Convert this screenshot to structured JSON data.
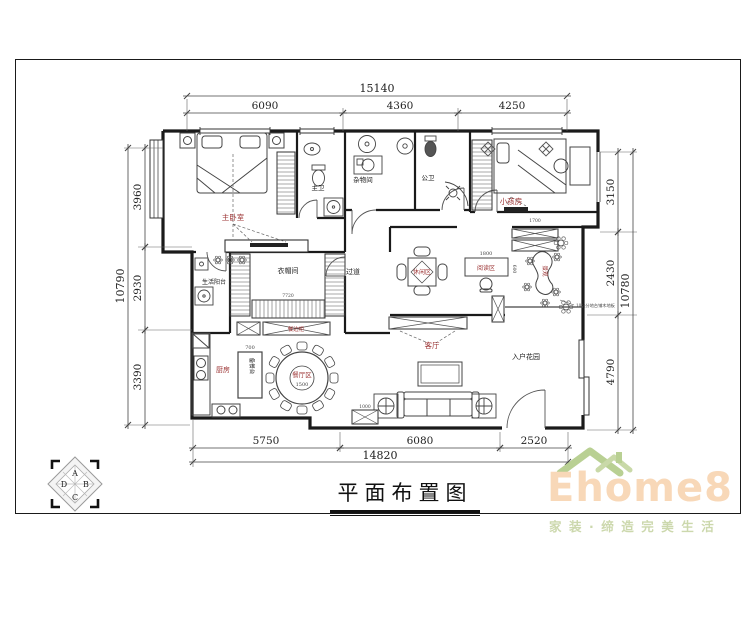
{
  "sheet": {
    "title": "平面布置图"
  },
  "dimensions": {
    "top": {
      "overall": "15140",
      "segments": [
        "6090",
        "4360",
        "4250"
      ]
    },
    "bottom": {
      "overall": "14820",
      "segments": [
        "5750",
        "6080",
        "2520"
      ]
    },
    "left": {
      "overall": "10790",
      "segments": [
        "3960",
        "2930",
        "3390"
      ]
    },
    "right": {
      "overall": "10780",
      "segments": [
        "3150",
        "2430",
        "4790"
      ]
    }
  },
  "rooms": {
    "master_bedroom": "主卧室",
    "master_bath": "主卫",
    "storage": "杂物间",
    "public_bath": "公卫",
    "kids_room": "小孩房",
    "cloakroom": "衣帽间",
    "hallway": "过道",
    "living_balcony": "生活阳台",
    "kitchen": "厨房",
    "dining_zone": "餐厅区",
    "living_room": "客厅",
    "reading_zone": "阅读区",
    "leisure_zone": "休闲区",
    "entry_garden": "入户花园",
    "sideboard": "餐边柜",
    "prep_counter": "备餐台",
    "landscape": "景观"
  },
  "inline_dims": {
    "dining_table": "1500",
    "island": "700",
    "desk_width": "1800",
    "desk_depth": "600",
    "side_cabinet": "1000",
    "cloak_width": "7720",
    "top_cabinet": "1700"
  },
  "annotations": {
    "platform_note": "10公分地台铺木地板"
  },
  "compass": {
    "top": "A",
    "right": "B",
    "bottom": "C",
    "left": "D"
  },
  "logo": {
    "brand": "Ehome8",
    "tagline": "家装·缔造完美生活"
  },
  "colors": {
    "label_red": "#9c3434",
    "logo_text": "#f8d8b8",
    "logo_roof": "#b9d093",
    "tagline": "#ccd8ad",
    "wall": "#1a1a1a"
  }
}
